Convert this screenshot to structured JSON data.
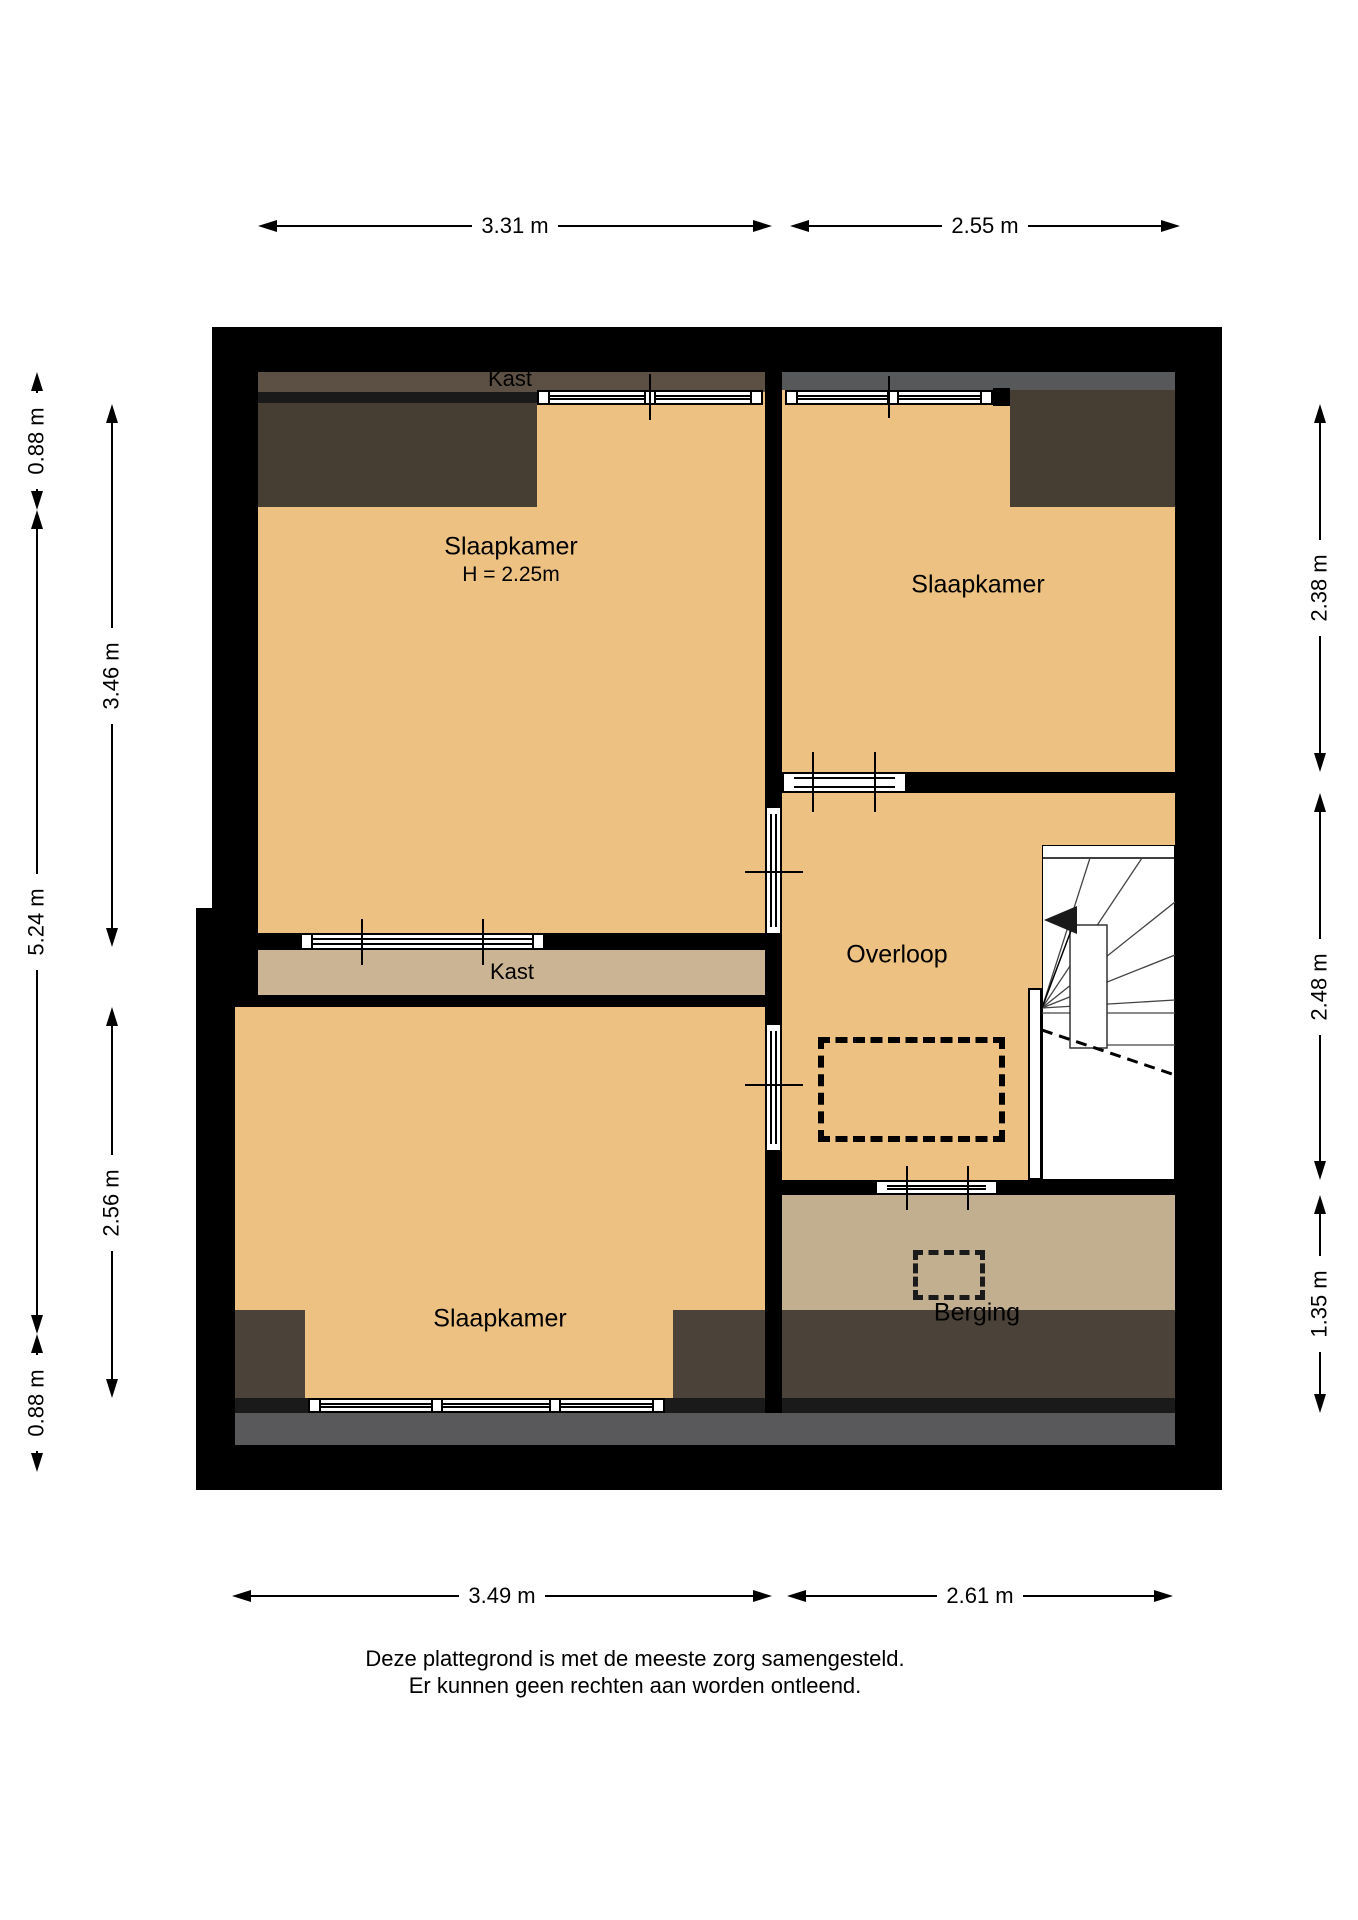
{
  "floorplan": {
    "title": "Floor plan (plattegrond) - first floor",
    "rooms": {
      "kast_top": {
        "label": "Kast"
      },
      "slaapkamer_1": {
        "label": "Slaapkamer",
        "height_note": "H = 2.25m"
      },
      "slaapkamer_2": {
        "label": "Slaapkamer"
      },
      "overloop": {
        "label": "Overloop"
      },
      "kast_middle": {
        "label": "Kast"
      },
      "slaapkamer_3": {
        "label": "Slaapkamer"
      },
      "berging": {
        "label": "Berging"
      }
    },
    "dimensions": {
      "top": [
        {
          "label": "3.31 m"
        },
        {
          "label": "2.55 m"
        }
      ],
      "bottom": [
        {
          "label": "3.49 m"
        },
        {
          "label": "2.61 m"
        }
      ],
      "left_inner": [
        {
          "label": "0.88 m"
        },
        {
          "label": "5.24 m"
        },
        {
          "label": "0.88 m"
        }
      ],
      "left_outer": [
        {
          "label": "3.46 m"
        },
        {
          "label": "2.56 m"
        }
      ],
      "right": [
        {
          "label": "2.38 m"
        },
        {
          "label": "2.48 m"
        },
        {
          "label": "1.35 m"
        }
      ]
    },
    "disclaimer": {
      "line1": "Deze plattegrond is met de meeste zorg samengesteld.",
      "line2": "Er kunnen geen rechten aan worden ontleend."
    },
    "colors": {
      "wall": "#000000",
      "room_fill": "#ecc181",
      "closet_fill": "#cbb494",
      "storage_fill": "#c2af90",
      "roof_shadow": "#473e33",
      "roof_shadow_strip": "#5c5044",
      "gray_strip": "#57585a",
      "gray_band": "#59595b"
    }
  }
}
